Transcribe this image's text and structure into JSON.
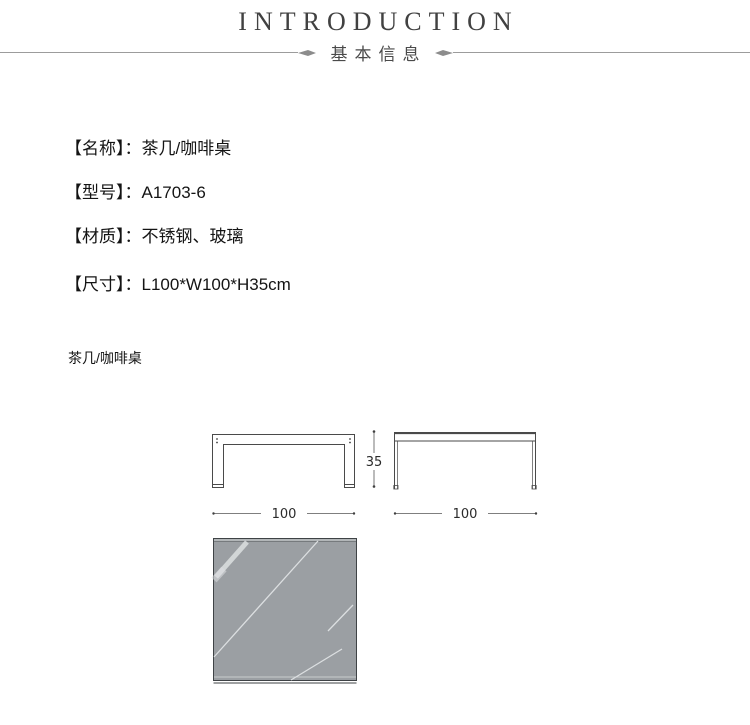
{
  "header": {
    "title": "INTRODUCTION",
    "subtitle": "基本信息"
  },
  "specs": [
    {
      "label": "【名称】：",
      "value": "茶几/咖啡桌"
    },
    {
      "label": "【型号】：",
      "value": "A1703-6"
    },
    {
      "label": "【材质】：",
      "value": "不锈钢、玻璃"
    },
    {
      "label": "【尺寸】：",
      "value": "L100*W100*H35cm"
    }
  ],
  "drawing": {
    "caption": "茶几/咖啡桌",
    "height_dimension": "35",
    "front_width_dimension": "100",
    "side_width_dimension": "100",
    "colors": {
      "line": "#4a4a4a",
      "dim_line": "#555555",
      "glass_fill": "#9b9fa3",
      "reflection": "#dcdfe1"
    }
  }
}
